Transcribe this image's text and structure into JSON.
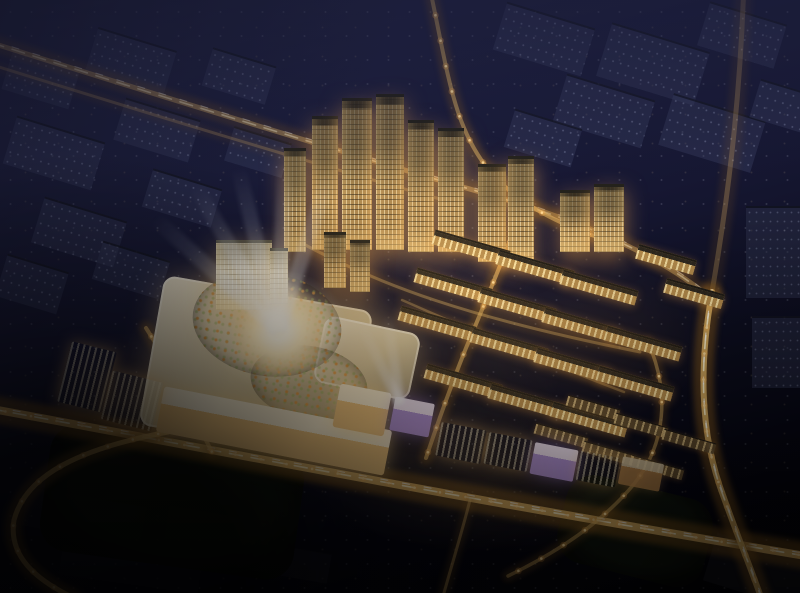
{
  "meta": {
    "type": "night-aerial-architectural-rendering",
    "visible_text": "none"
  },
  "palette": {
    "sky_top": "#262849",
    "sky_mid": "#161732",
    "sky_bottom": "#020204",
    "road_core": "#eec06c",
    "road_glow": "#8a5c1e",
    "trail": "#fff3cc",
    "trail2": "#ffffff",
    "lamp": "#ffdf9e",
    "lamp_halo": "rgba(255,176,80,0.28)",
    "facade_warm": "#caa267",
    "facade_bright": "#efe5cb",
    "window_warm": "#ffe9b0",
    "garden_green": "#3c5330",
    "accent_purple": "#a388d8",
    "beam_white": "#eef3ff"
  },
  "scene": {
    "defaults": {
      "blocks": {
        "cls": "dim",
        "rot": 17
      },
      "buildings": {
        "cls": "row",
        "rot": 16,
        "w": 78,
        "h": 15
      },
      "mall": {
        "rot": 0
      }
    },
    "blocks": [
      {
        "x": 6,
        "y": 58,
        "w": 70,
        "h": 42
      },
      {
        "x": 90,
        "y": 38,
        "w": 82,
        "h": 46
      },
      {
        "x": 8,
        "y": 128,
        "w": 92,
        "h": 50
      },
      {
        "x": 118,
        "y": 108,
        "w": 78,
        "h": 44
      },
      {
        "x": 206,
        "y": 56,
        "w": 66,
        "h": 40
      },
      {
        "x": 36,
        "y": 208,
        "w": 86,
        "h": 48
      },
      {
        "x": 146,
        "y": 178,
        "w": 72,
        "h": 40
      },
      {
        "x": 228,
        "y": 134,
        "w": 60,
        "h": 36
      },
      {
        "x": 0,
        "y": 262,
        "w": 64,
        "h": 44
      },
      {
        "x": 96,
        "y": 250,
        "w": 70,
        "h": 40
      },
      {
        "x": 498,
        "y": 14,
        "w": 92,
        "h": 50
      },
      {
        "x": 602,
        "y": 36,
        "w": 102,
        "h": 56
      },
      {
        "x": 702,
        "y": 12,
        "w": 80,
        "h": 46
      },
      {
        "x": 558,
        "y": 86,
        "w": 92,
        "h": 50
      },
      {
        "x": 664,
        "y": 106,
        "w": 96,
        "h": 54
      },
      {
        "x": 754,
        "y": 86,
        "w": 56,
        "h": 40
      },
      {
        "x": 508,
        "y": 118,
        "w": 70,
        "h": 40
      },
      {
        "cls": "dim-slab",
        "rot": 0,
        "x": 746,
        "y": 206,
        "w": 58,
        "h": 92
      },
      {
        "cls": "dim-slab",
        "rot": 0,
        "x": 752,
        "y": 316,
        "w": 52,
        "h": 72
      },
      {
        "cls": "dim-dark",
        "rot": 17,
        "x": 708,
        "y": 546,
        "w": 100,
        "h": 50
      },
      {
        "cls": "dim-dark",
        "rot": 10,
        "x": 24,
        "y": 496,
        "w": 120,
        "h": 40
      },
      {
        "cls": "dim-dark",
        "rot": 10,
        "x": 166,
        "y": 514,
        "w": 104,
        "h": 36
      },
      {
        "cls": "dim-dark",
        "rot": 8,
        "x": 60,
        "y": 554,
        "w": 140,
        "h": 30
      },
      {
        "cls": "dim-dark",
        "rot": 10,
        "x": 238,
        "y": 546,
        "w": 92,
        "h": 30
      },
      {
        "cls": "park",
        "rot": 8,
        "x": 44,
        "y": 438,
        "w": 256,
        "h": 128
      },
      {
        "cls": "park",
        "rot": 14,
        "x": 560,
        "y": 486,
        "w": 150,
        "h": 90
      }
    ],
    "mall": [
      {
        "cls": "mall-roof",
        "name": "mall-main-roof",
        "x": 150,
        "y": 292,
        "w": 212,
        "h": 152,
        "rot": 10
      },
      {
        "cls": "mall-roof",
        "name": "mall-east-wing",
        "x": 318,
        "y": 324,
        "w": 98,
        "h": 68,
        "rot": 12
      },
      {
        "cls": "garden",
        "name": "roof-garden-ring",
        "x": 192,
        "y": 272,
        "w": 150,
        "h": 104,
        "rot": 10
      },
      {
        "cls": "garden",
        "name": "roof-garden-south",
        "x": 250,
        "y": 346,
        "w": 118,
        "h": 74,
        "rot": 10
      },
      {
        "cls": "plaza",
        "name": "central-plaza",
        "x": 228,
        "y": 280,
        "w": 100,
        "h": 100
      },
      {
        "cls": "com-bright",
        "name": "mall-south-frontage",
        "x": 158,
        "y": 408,
        "w": 232,
        "h": 46,
        "rot": 11
      }
    ],
    "buildings": [
      {
        "cls": "tower",
        "rot": 0,
        "x": 312,
        "y": 116,
        "w": 26,
        "h": 134
      },
      {
        "cls": "tower",
        "rot": 0,
        "x": 342,
        "y": 98,
        "w": 30,
        "h": 152
      },
      {
        "cls": "tower",
        "rot": 0,
        "x": 376,
        "y": 94,
        "w": 28,
        "h": 156
      },
      {
        "cls": "tower",
        "rot": 0,
        "x": 408,
        "y": 120,
        "w": 26,
        "h": 132
      },
      {
        "cls": "tower",
        "rot": 0,
        "x": 438,
        "y": 128,
        "w": 26,
        "h": 124
      },
      {
        "cls": "tower",
        "rot": 0,
        "x": 284,
        "y": 148,
        "w": 22,
        "h": 104
      },
      {
        "cls": "tower",
        "rot": 0,
        "x": 478,
        "y": 164,
        "w": 28,
        "h": 98
      },
      {
        "cls": "tower",
        "rot": 0,
        "x": 508,
        "y": 156,
        "w": 26,
        "h": 106
      },
      {
        "cls": "tower",
        "rot": 0,
        "x": 560,
        "y": 190,
        "w": 30,
        "h": 62
      },
      {
        "cls": "tower",
        "rot": 0,
        "x": 594,
        "y": 184,
        "w": 30,
        "h": 68
      },
      {
        "cls": "tower-bright",
        "rot": 0,
        "x": 216,
        "y": 240,
        "w": 56,
        "h": 70
      },
      {
        "cls": "tower-bright",
        "rot": 0,
        "x": 270,
        "y": 248,
        "w": 18,
        "h": 56
      },
      {
        "cls": "tower",
        "rot": 0,
        "x": 324,
        "y": 232,
        "w": 22,
        "h": 56
      },
      {
        "cls": "tower",
        "rot": 0,
        "x": 350,
        "y": 240,
        "w": 20,
        "h": 52
      },
      {
        "x": 432,
        "y": 240
      },
      {
        "x": 496,
        "y": 260
      },
      {
        "x": 560,
        "y": 280
      },
      {
        "x": 414,
        "y": 278
      },
      {
        "x": 478,
        "y": 298
      },
      {
        "x": 542,
        "y": 318
      },
      {
        "x": 604,
        "y": 336
      },
      {
        "x": 398,
        "y": 316
      },
      {
        "x": 470,
        "y": 338
      },
      {
        "x": 534,
        "y": 358
      },
      {
        "x": 596,
        "y": 376
      },
      {
        "x": 424,
        "y": 374
      },
      {
        "x": 488,
        "y": 394
      },
      {
        "x": 550,
        "y": 412
      },
      {
        "x": 636,
        "y": 252,
        "w": 60
      },
      {
        "x": 664,
        "y": 286,
        "w": 60
      },
      {
        "cls": "villa",
        "w": 54,
        "h": 11,
        "x": 566,
        "y": 402
      },
      {
        "cls": "villa",
        "w": 54,
        "h": 11,
        "x": 614,
        "y": 420
      },
      {
        "cls": "villa",
        "w": 54,
        "h": 11,
        "x": 662,
        "y": 436
      },
      {
        "cls": "villa",
        "w": 54,
        "h": 11,
        "x": 534,
        "y": 430
      },
      {
        "cls": "villa",
        "w": 54,
        "h": 11,
        "x": 582,
        "y": 448
      },
      {
        "cls": "villa",
        "w": 54,
        "h": 11,
        "x": 630,
        "y": 462
      },
      {
        "cls": "com-bright",
        "name": "street-plaza-building",
        "rot": 11,
        "x": 336,
        "y": 388,
        "w": 52,
        "h": 44
      },
      {
        "cls": "com-purple",
        "rot": 11,
        "x": 392,
        "y": 400,
        "w": 40,
        "h": 34
      },
      {
        "cls": "com-warm",
        "rot": 11,
        "x": 438,
        "y": 426,
        "w": 46,
        "h": 34
      },
      {
        "cls": "com-warm",
        "rot": 11,
        "x": 486,
        "y": 436,
        "w": 44,
        "h": 32
      },
      {
        "cls": "com-purple",
        "rot": 11,
        "x": 532,
        "y": 446,
        "w": 44,
        "h": 32
      },
      {
        "cls": "com-warm",
        "rot": 11,
        "x": 578,
        "y": 454,
        "w": 40,
        "h": 30
      },
      {
        "cls": "com-warm-dim",
        "rot": 11,
        "x": 620,
        "y": 460,
        "w": 42,
        "h": 28
      },
      {
        "cls": "com-warm",
        "rot": 14,
        "x": 64,
        "y": 346,
        "w": 46,
        "h": 62
      },
      {
        "cls": "com-warm",
        "rot": 14,
        "x": 106,
        "y": 376,
        "w": 52,
        "h": 50
      }
    ],
    "roads": [
      {
        "name": "main-avenue",
        "path": "M -30 405 C 180 443 420 492 830 560",
        "w": 8,
        "op": 1,
        "lamps": true,
        "dash": true
      },
      {
        "name": "west-loop-road",
        "path": "M 168 432 C 82 448 26 474 14 520 C 8 556 36 580 74 598",
        "w": 5,
        "op": 0.9,
        "lamps": true
      },
      {
        "name": "north-arterial",
        "path": "M -30 36 C 160 96 340 152 480 192 C 572 218 652 250 708 296",
        "w": 5,
        "op": 0.5,
        "dash": true
      },
      {
        "name": "north-arterial-2",
        "path": "M -30 58 C 150 114 320 166 458 204",
        "w": 3,
        "op": 0.3
      },
      {
        "name": "north-entry-road",
        "path": "M 428 -20 C 448 70 452 130 494 176 C 522 206 560 224 600 238",
        "w": 4,
        "op": 0.6,
        "lamps": true
      },
      {
        "name": "right-highway-upper",
        "path": "M 744 -20 C 740 110 726 210 712 292",
        "w": 5,
        "op": 0.3
      },
      {
        "name": "right-highway",
        "path": "M 712 292 C 700 360 698 430 724 498 C 736 532 750 566 762 600",
        "w": 6,
        "op": 0.95,
        "lamps": true,
        "dash": true
      },
      {
        "name": "estate-spine-road",
        "path": "M 524 200 C 506 254 486 300 466 348 C 450 388 438 422 426 458",
        "w": 4,
        "op": 0.7,
        "lamps": true
      },
      {
        "name": "estate-cross-north",
        "path": "M 296 240 C 380 286 470 318 640 352",
        "w": 3,
        "op": 0.45
      },
      {
        "name": "estate-cross-south",
        "path": "M 402 300 C 470 330 540 360 624 392",
        "w": 2.5,
        "op": 0.4
      },
      {
        "name": "mall-west-street",
        "path": "M 146 328 C 172 368 190 410 212 452",
        "w": 4,
        "op": 0.7,
        "lamps": true
      },
      {
        "name": "estate-east-loop",
        "path": "M 648 342 C 670 392 666 444 634 484 C 606 518 566 548 508 576",
        "w": 3.5,
        "op": 0.55,
        "lamps": true
      },
      {
        "name": "south-branch",
        "path": "M 470 500 C 462 532 452 564 442 600",
        "w": 3,
        "op": 0.5
      }
    ],
    "beams": [
      {
        "name": "plaza-searchlights",
        "cx": 278,
        "cy": 330,
        "w": 15,
        "h": 178,
        "angles": [
          -48,
          -30,
          -14,
          2,
          18
        ]
      },
      {
        "name": "street-searchlights",
        "cx": 400,
        "cy": 404,
        "w": 10,
        "h": 96,
        "angles": [
          -26,
          -8
        ]
      }
    ],
    "glows": [
      {
        "name": "center-warm-glow",
        "x": 110,
        "y": 200,
        "w": 470,
        "h": 310,
        "color": "rgba(255,184,92,0.20)"
      },
      {
        "name": "street-warm-glow",
        "x": 290,
        "y": 382,
        "w": 400,
        "h": 180,
        "color": "rgba(255,196,110,0.17)"
      },
      {
        "name": "estate-warm-glow",
        "x": 420,
        "y": 228,
        "w": 310,
        "h": 220,
        "color": "rgba(255,178,88,0.12)"
      },
      {
        "name": "plaza-white-glow",
        "x": 203,
        "y": 265,
        "w": 150,
        "h": 130,
        "color": "rgba(255,248,228,0.55)"
      },
      {
        "name": "west-strip-glow",
        "x": 36,
        "y": 326,
        "w": 170,
        "h": 150,
        "color": "rgba(255,186,100,0.15)"
      },
      {
        "name": "north-towers-glow",
        "x": 290,
        "y": 120,
        "w": 290,
        "h": 180,
        "color": "rgba(255,190,110,0.10)"
      }
    ]
  }
}
